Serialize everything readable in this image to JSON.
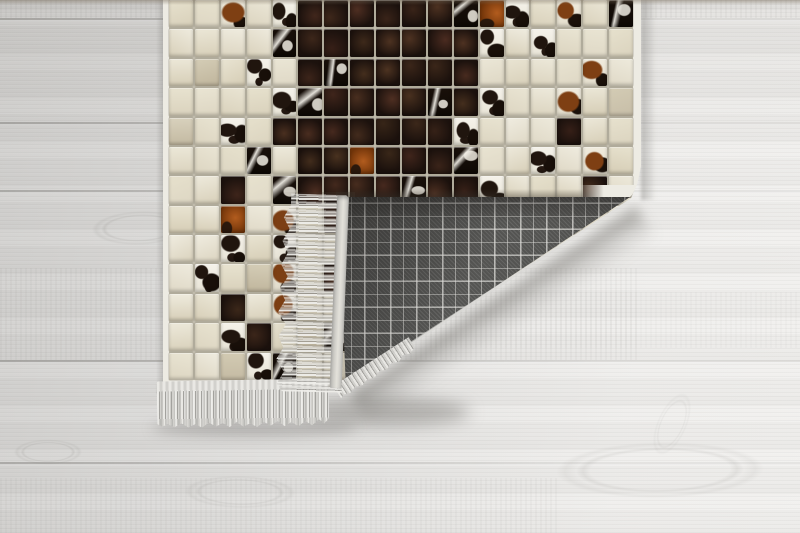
{
  "meta": {
    "type": "product-photo",
    "subject": "patchwork cowhide mosaic rug with corner folded over showing gray plaid woven backing and fringe",
    "setting": "light gray wooden plank floor"
  },
  "floor": {
    "base_colors": [
      "#d0cfcd",
      "#dcdbd9",
      "#e7e6e4",
      "#efeeec"
    ],
    "seam_color": "#6e6c68",
    "plank_seams_y": [
      18,
      122,
      190,
      360,
      462
    ],
    "grain_bands": [
      {
        "x": 0,
        "y": 0,
        "w": 800,
        "h": 18,
        "o": 0.55
      },
      {
        "x": 0,
        "y": 268,
        "w": 640,
        "h": 92,
        "o": 0.5
      },
      {
        "x": 430,
        "y": 292,
        "w": 370,
        "h": 56,
        "o": 0.3
      },
      {
        "x": 0,
        "y": 478,
        "w": 560,
        "h": 55,
        "o": 0.45
      }
    ],
    "knots": [
      {
        "x": 140,
        "y": 228,
        "w": 130,
        "h": 46,
        "o": 0.55,
        "rot": -2
      },
      {
        "x": 48,
        "y": 452,
        "w": 92,
        "h": 34,
        "o": 0.55,
        "rot": 0
      },
      {
        "x": 240,
        "y": 492,
        "w": 150,
        "h": 44,
        "o": 0.45,
        "rot": 1
      },
      {
        "x": 660,
        "y": 470,
        "w": 280,
        "h": 76,
        "o": 0.4,
        "rot": -1
      },
      {
        "x": 672,
        "y": 424,
        "w": 40,
        "h": 90,
        "o": 0.3,
        "rot": 24
      }
    ]
  },
  "rug": {
    "frame": {
      "left": 163,
      "top": 0,
      "width": 478,
      "height": 387
    },
    "border_color": "#edebe3",
    "grout_color": "#c2bdae",
    "tile_cols": 18,
    "tile_rows": 13,
    "tile_map": [
      "CCRCWKKKKKKDBWCRCD",
      "CCCCDKKKKKKKWCWCCC",
      "CcCWCKDKKKKKCCCCRC",
      "CCCCWDKKKKDKWCCRCc",
      "cCWCKKKKKKKWCCCKCC",
      "CCCDCKKBKKKDCCWCRC",
      "CCKCDKKKKDKKWCCCKC",
      "CCBCRCKKKKKKCCCCCC",
      "CCWCWCCKKKKKKCCCCC",
      "CWCcRCKKKKKKKCCCCC",
      "CCKCRCCKKKKKKCCCCC",
      "CCWKCcDKKKKKKCCCCC",
      "CCcWDCCKKKKKKCCCCC"
    ],
    "palette": {
      "C": "#e7e0c9",
      "c": "#d7cfb5",
      "K": "#1b110a",
      "W": "#f3f0e7",
      "R": "#7e3f13",
      "B": "#9a4c16",
      "D": "#140d07"
    },
    "palette_legend": {
      "C": "cream leather",
      "c": "dark cream leather",
      "K": "black hide",
      "W": "white hide with black spots",
      "R": "tricolor brown hide",
      "B": "rust hide",
      "D": "black hide with white streaks"
    }
  },
  "fold": {
    "backing_base": "#5c5c5a",
    "backing_dark": "#4e4e4c",
    "backing_dark2": "#555553",
    "backing_line": "#e2e1dd",
    "binding_color": "#e3e1da",
    "triangle": {
      "left": 338,
      "top": 197,
      "width": 292,
      "height": 189
    }
  },
  "fringe": {
    "light": "#e9e8e4",
    "mid": "#d2d1cd",
    "dark": "#a3a29e"
  },
  "shadows": {
    "soft": "rgba(100,98,94,0.45)"
  }
}
